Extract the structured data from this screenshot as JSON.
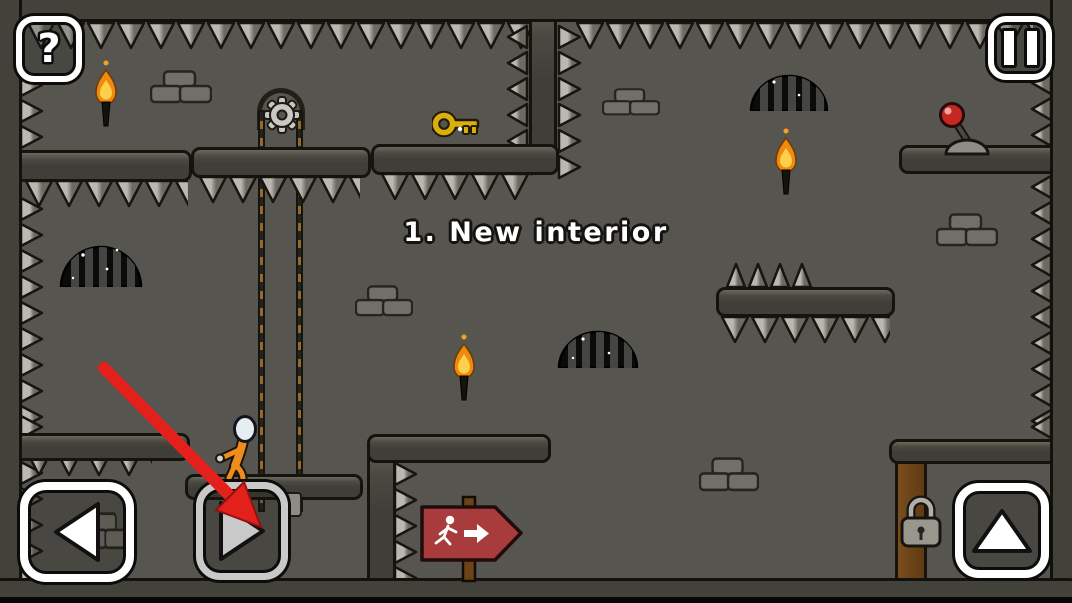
{
  "level": {
    "title": "1. New interior"
  },
  "hud": {
    "help_label": "?",
    "pause_icon": "pause-icon",
    "move_left_icon": "triangle-left-icon",
    "move_right_icon": "triangle-right-icon",
    "jump_icon": "triangle-up-icon"
  },
  "tutorial": {
    "hint_target": "move-right-button"
  },
  "colors": {
    "background": "#57554f",
    "wall": "#3f3e38",
    "wall_dark": "#42413a",
    "outline": "#14130e",
    "spike_light": "#bab8b1",
    "spike_dark": "#6d6a62",
    "button_white": "#ffffff",
    "button_gray": "#c9c9c9",
    "tutorial_red": "#e3201b",
    "sign_red": "#a83b3b",
    "key_gold": "#d9af10",
    "flame_orange": "#ef8a10",
    "flame_core": "#fcd04a",
    "character_orange": "#ee8c1d",
    "lever_red": "#c52823",
    "chain_brown": "#96682a",
    "wood_brown": "#6b4317",
    "brick_gray": "#716f69"
  },
  "scene": {
    "character": "prisoner-stickman",
    "objects": [
      "key",
      "lever",
      "padlock",
      "exit-sign",
      "elevator-chain",
      "gear",
      "torch",
      "torch",
      "torch",
      "vent-dome",
      "vent-dome",
      "vent-dome",
      "bricks",
      "bricks",
      "bricks",
      "bricks",
      "bricks",
      "bricks",
      "spikes"
    ]
  }
}
